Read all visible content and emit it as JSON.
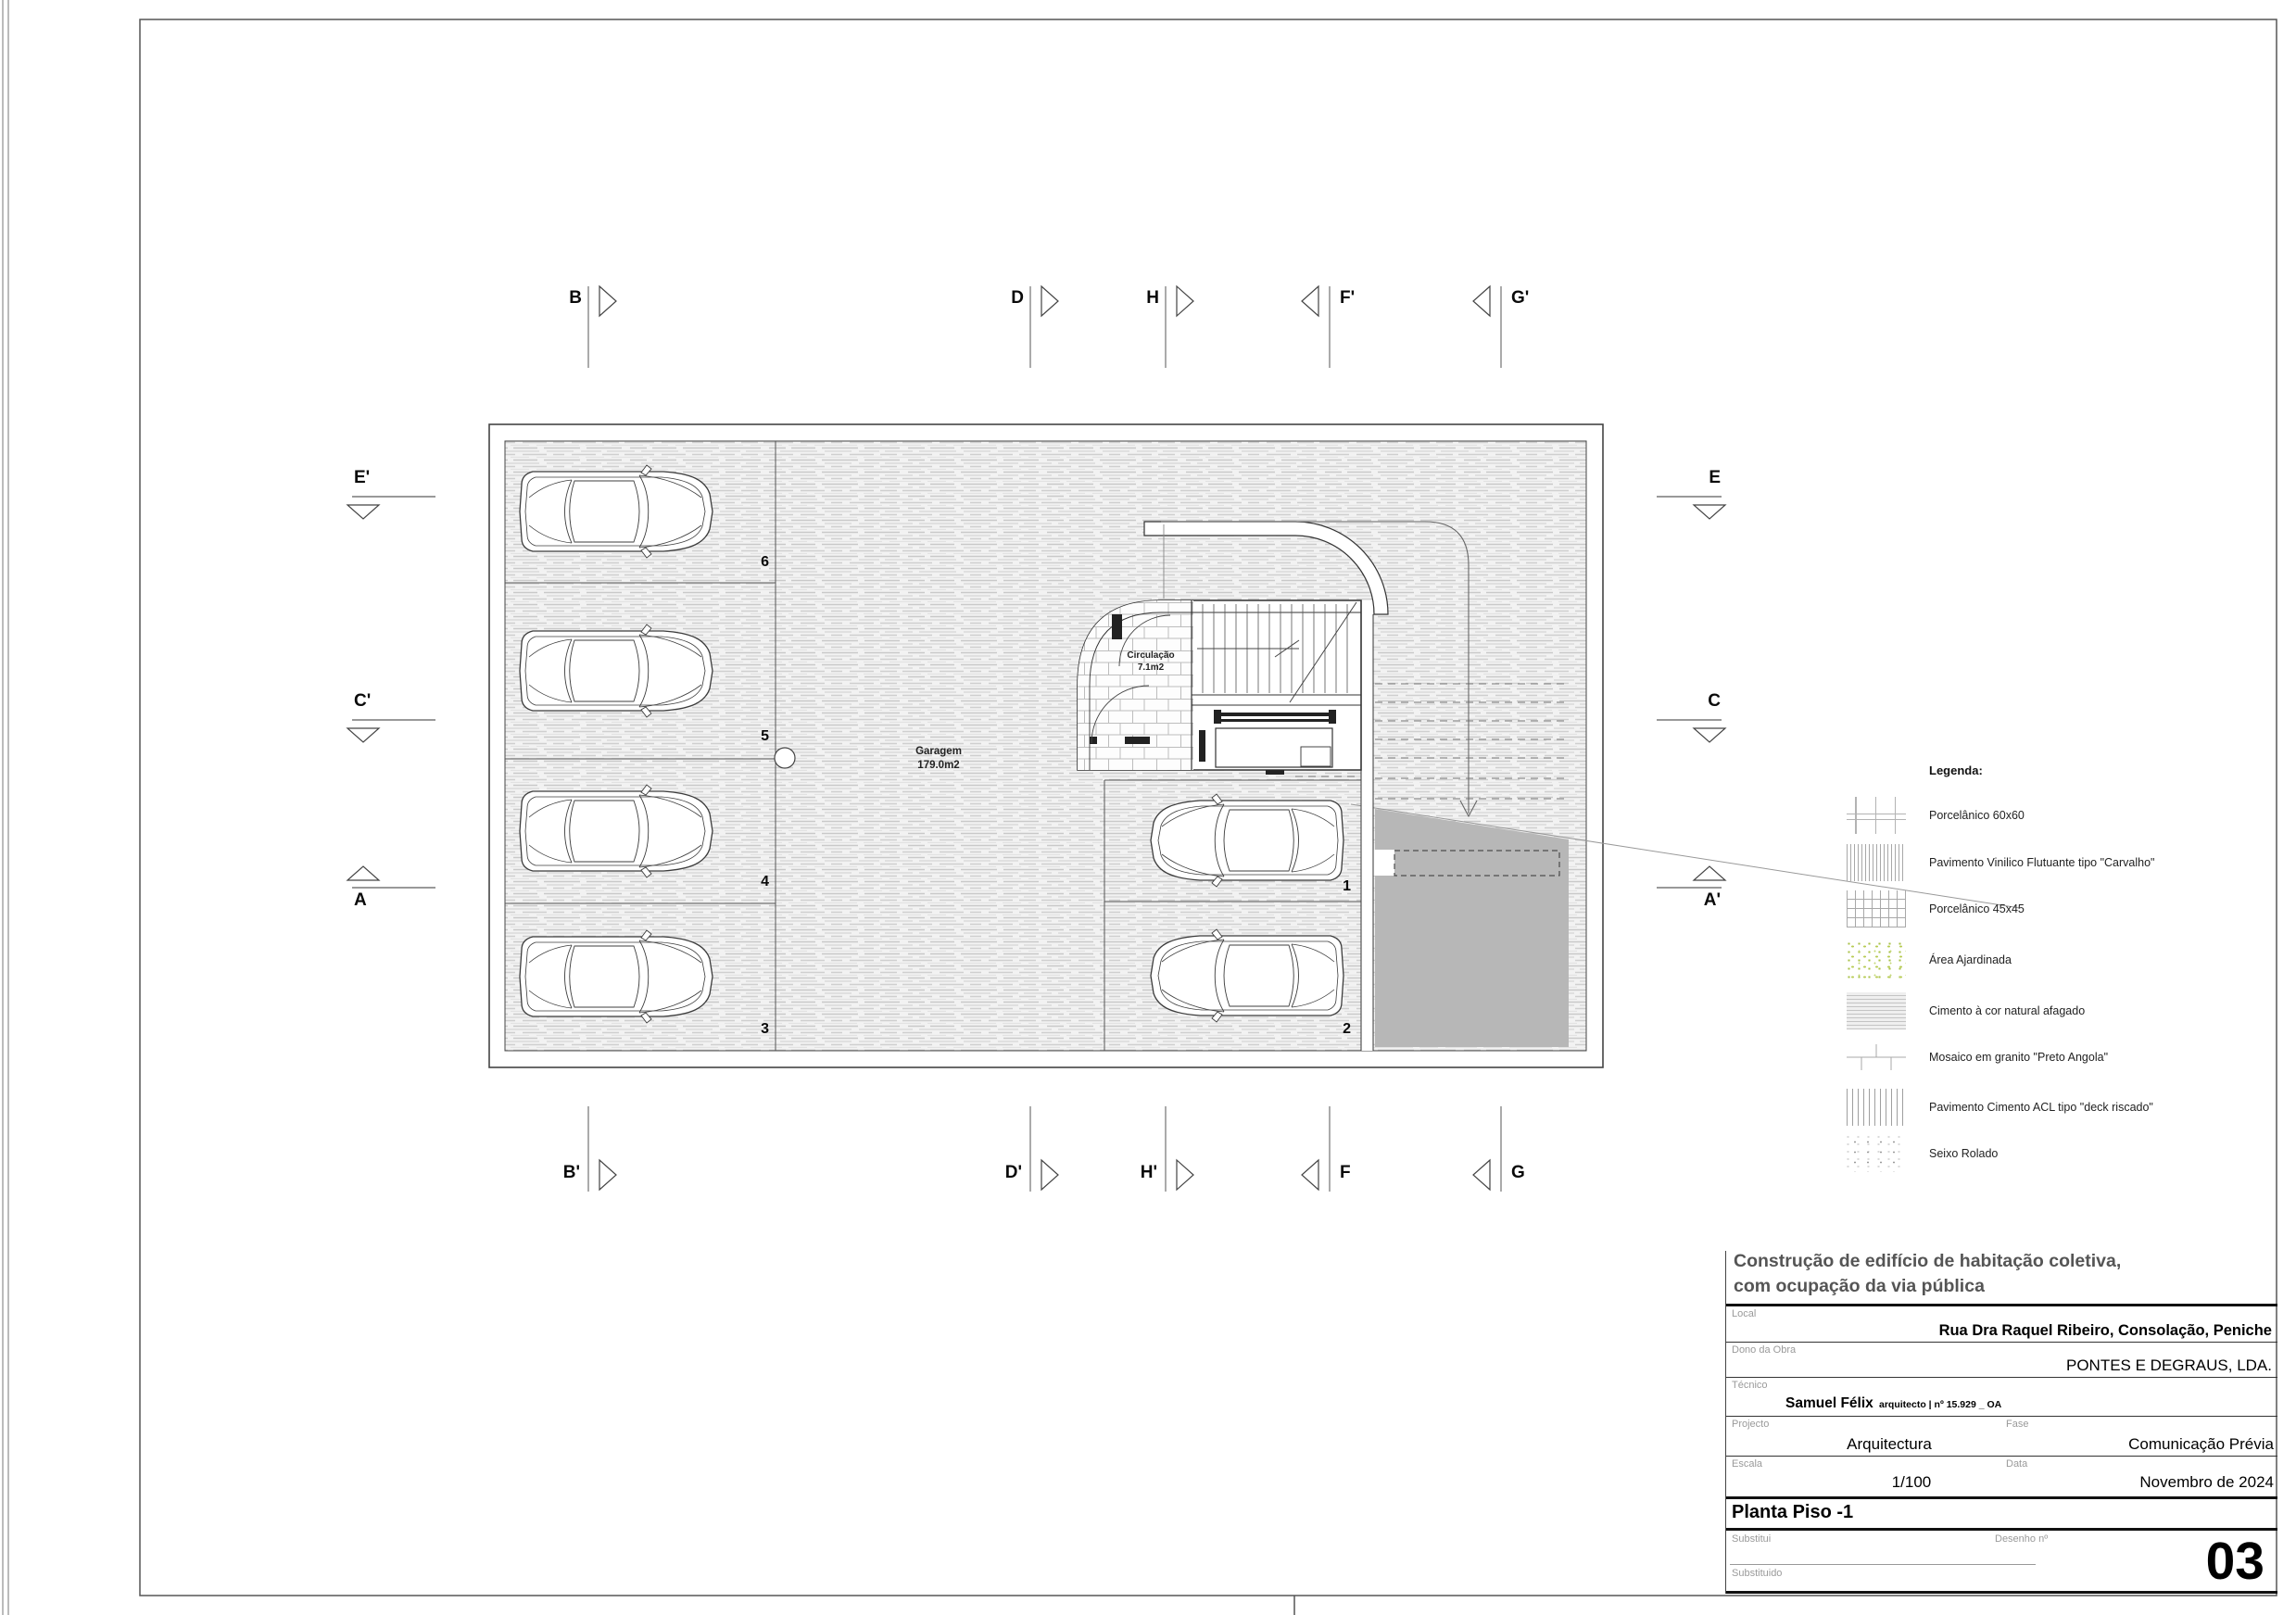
{
  "colors": {
    "ramp_gray": "#b7b7b7",
    "garden_green": "#b8cc55"
  },
  "plan": {
    "garage_name": "Garagem",
    "garage_area": "179.0m2",
    "circulation_name": "Circulação",
    "circulation_area": "7.1m2",
    "stalls": [
      "6",
      "5",
      "4",
      "3",
      "1",
      "2"
    ],
    "markers_top": [
      "B",
      "D",
      "H",
      "F'",
      "G'"
    ],
    "markers_bottom": [
      "B'",
      "D'",
      "H'",
      "F",
      "G"
    ],
    "markers_left": [
      "E'",
      "C'",
      "A"
    ],
    "markers_right": [
      "E",
      "C",
      "A'"
    ]
  },
  "legend": {
    "title": "Legenda:",
    "items": [
      "Porcelânico 60x60",
      "Pavimento Vinilico Flutuante tipo \"Carvalho\"",
      "Porcelânico 45x45",
      "Área Ajardinada",
      "Cimento à cor natural afagado",
      "Mosaico em granito \"Preto Angola\"",
      "Pavimento Cimento ACL tipo \"deck riscado\"",
      "Seixo Rolado"
    ]
  },
  "titleblock": {
    "title_line1": "Construção de edifício de habitação coletiva,",
    "title_line2": "com ocupação da via pública",
    "local_label": "Local",
    "local_value": "Rua Dra Raquel Ribeiro, Consolação, Peniche",
    "owner_label": "Dono da Obra",
    "owner_value": "PONTES E DEGRAUS, LDA.",
    "tech_label": "Técnico",
    "tech_name": "Samuel Félix",
    "tech_credentials": "arquitecto | nº 15.929 _ OA",
    "project_label": "Projecto",
    "project_value": "Arquitectura",
    "phase_label": "Fase",
    "phase_value": "Comunicação Prévia",
    "scale_label": "Escala",
    "scale_value": "1/100",
    "date_label": "Data",
    "date_value": "Novembro de 2024",
    "drawing_name": "Planta Piso -1",
    "replaces_label": "Substitui",
    "replaced_label": "Substituido",
    "number_label": "Desenho nº",
    "number_value": "03"
  }
}
